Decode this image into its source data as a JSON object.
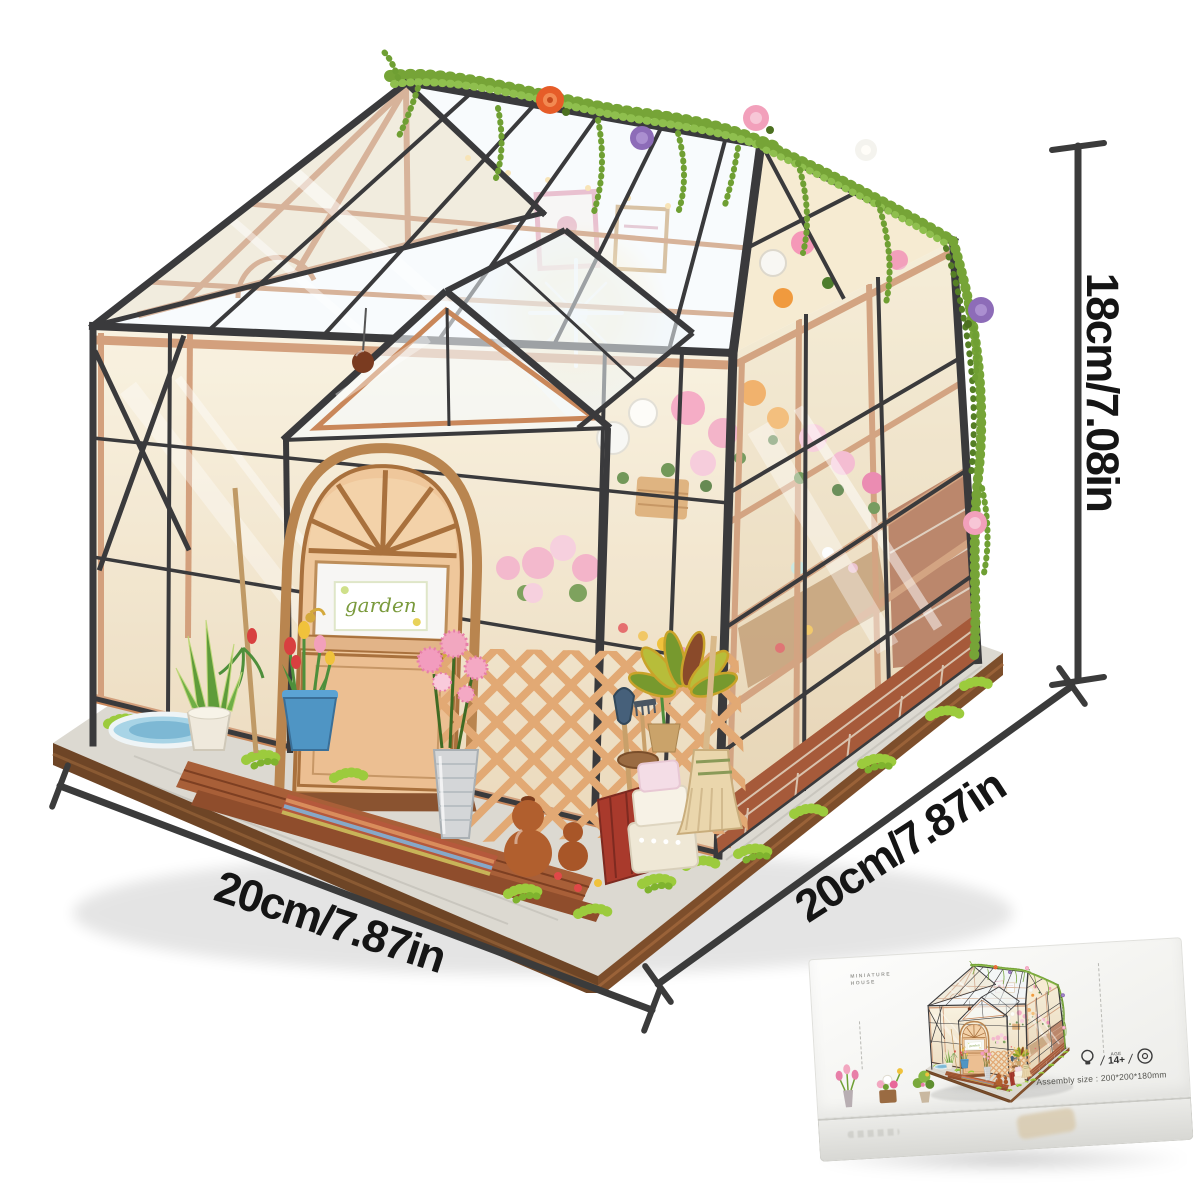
{
  "scene": {
    "subject": "DIY miniature greenhouse dollhouse kit",
    "door_sign": "garden"
  },
  "dimensions": {
    "width_label": "20cm/7.87in",
    "depth_label": "20cm/7.87in",
    "height_label": "18cm/7.08in"
  },
  "box": {
    "brand_line1": "MINIATURE",
    "brand_line2": "HOUSE",
    "age_label": "AGE",
    "age_value": "14+",
    "assembly_text": "Assembly size : 200*200*180mm"
  },
  "colors": {
    "annotation": "#3b3b3b",
    "frame_black": "#3a3a3c",
    "wood_trim": "#c9875a",
    "door_wood": "#eec094",
    "vine_green": "#76a437",
    "grass_green": "#9ccb3d",
    "brick": "#a65a3a",
    "rose_orange": "#e65c28",
    "rose_purple": "#8d6cb8",
    "rose_pink": "#f2a0bb",
    "box_background": "#f7f7f5"
  }
}
